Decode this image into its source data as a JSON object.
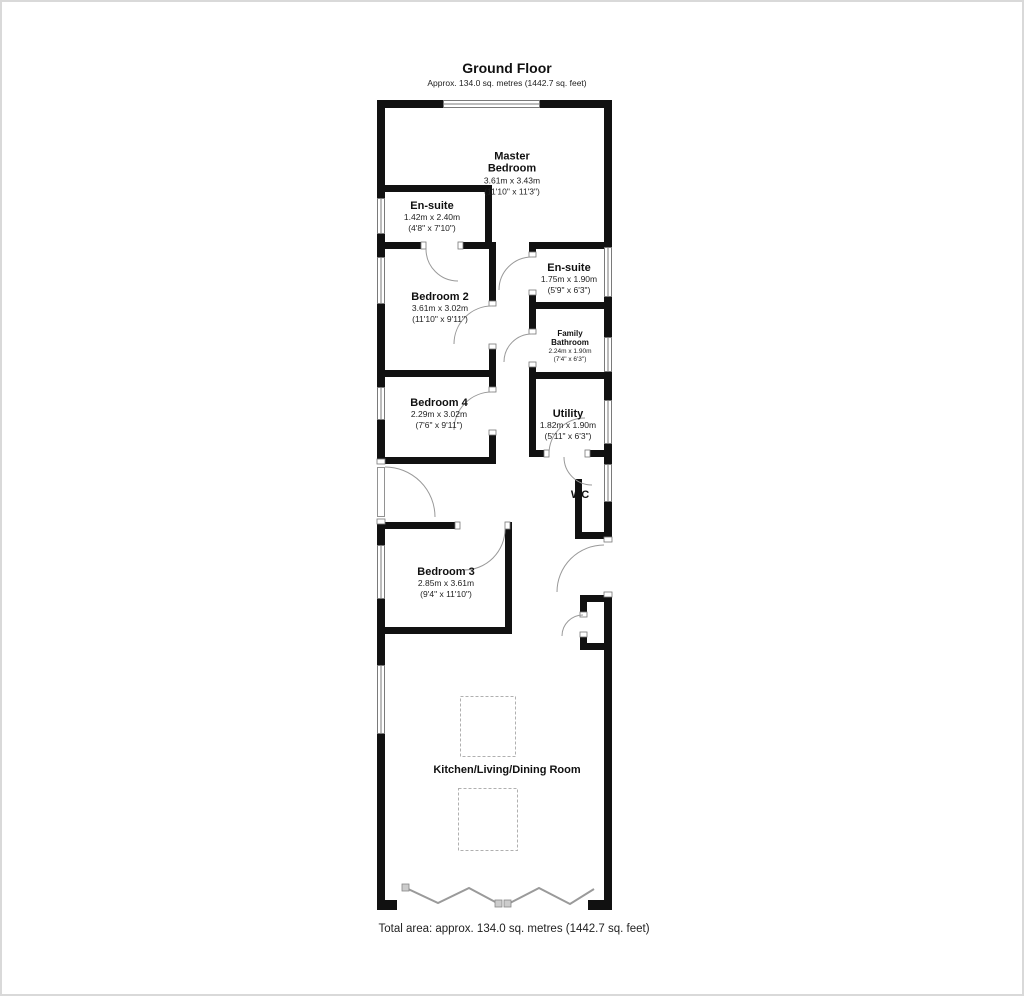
{
  "title": {
    "heading": "Ground Floor",
    "subheading": "Approx. 134.0 sq. metres (1442.7 sq. feet)"
  },
  "footer": {
    "total_area": "Total area: approx. 134.0 sq. metres (1442.7 sq. feet)"
  },
  "rooms": {
    "master_bedroom": {
      "name": "Master Bedroom",
      "metric": "3.61m x 3.43m",
      "imperial": "(11'10\" x 11'3\")"
    },
    "ensuite_master": {
      "name": "En-suite",
      "metric": "1.42m x 2.40m",
      "imperial": "(4'8\" x 7'10\")"
    },
    "bedroom_2": {
      "name": "Bedroom 2",
      "metric": "3.61m x 3.02m",
      "imperial": "(11'10\" x 9'11\")"
    },
    "ensuite_2": {
      "name": "En-suite",
      "metric": "1.75m x 1.90m",
      "imperial": "(5'9\" x 6'3\")"
    },
    "family_bathroom": {
      "name": "Family Bathroom",
      "metric": "2.24m x 1.90m",
      "imperial": "(7'4\" x 6'3\")"
    },
    "bedroom_4": {
      "name": "Bedroom 4",
      "metric": "2.29m x 3.02m",
      "imperial": "(7'6\" x 9'11\")"
    },
    "utility": {
      "name": "Utility",
      "metric": "1.82m x 1.90m",
      "imperial": "(5'11\" x 6'3\")"
    },
    "wc": {
      "name": "WC"
    },
    "bedroom_3": {
      "name": "Bedroom 3",
      "metric": "2.85m x 3.61m",
      "imperial": "(9'4\" x 11'10\")"
    },
    "kitchen": {
      "name": "Kitchen/Living/Dining Room"
    }
  },
  "colors": {
    "wall": "#111111",
    "window_line": "#7a7a7a",
    "door_arc": "#999999",
    "skylight_dash": "#b0b0b0",
    "frame_border": "#d9d9d9"
  }
}
